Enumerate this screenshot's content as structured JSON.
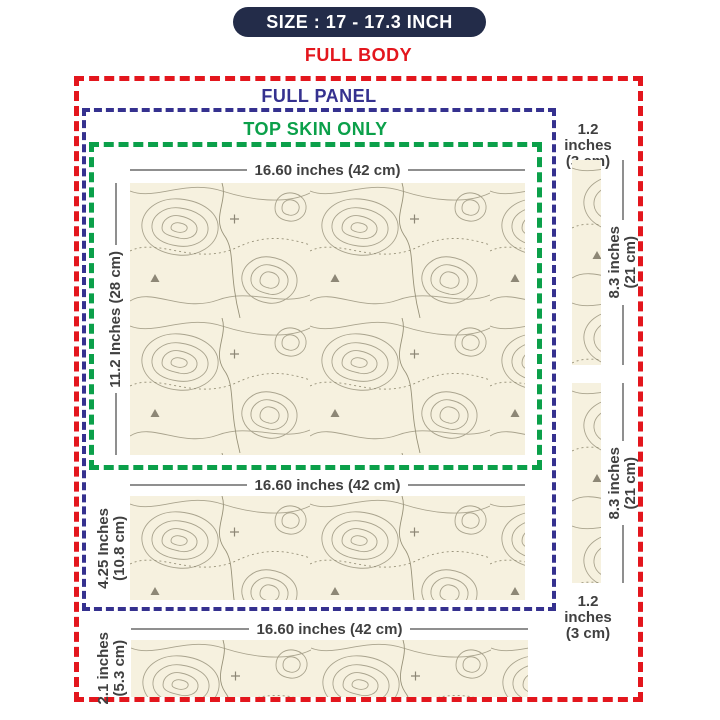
{
  "badge": {
    "text": "SIZE : 17 - 17.3 INCH"
  },
  "region_labels": {
    "full_body": "FULL BODY",
    "full_panel": "FULL PANEL",
    "top_skin": "TOP SKIN ONLY"
  },
  "dimensions": {
    "main": {
      "width": "16.60 inches (42 cm)",
      "height": "11.2 Inches (28 cm)"
    },
    "middle": {
      "width": "16.60 inches (42 cm)",
      "height_line1": "4.25 Inches",
      "height_line2": "(10.8 cm)"
    },
    "bottom": {
      "width": "16.60 inches (42 cm)",
      "height_line1": "2.1 inches",
      "height_line2": "(5.3 cm)"
    },
    "right_top": {
      "width_line1": "1.2 inches",
      "width_line2": "(3 cm)"
    },
    "right_strip1": {
      "height_line1": "8.3 inches",
      "height_line2": "(21 cm)"
    },
    "right_strip2": {
      "height_line1": "8.3 inches",
      "height_line2": "(21 cm)"
    },
    "right_bottom": {
      "width_line1": "1.2 inches",
      "width_line2": "(3 cm)"
    }
  },
  "colors": {
    "full_body_red": "#e3161d",
    "full_panel_navy": "#35318f",
    "top_skin_green": "#0ba04a",
    "badge_navy": "#232c49",
    "skin_cream": "#f6f1df",
    "contour_line": "#a9a38d",
    "dimension_text": "#404040",
    "dimension_line": "#8f8f8f"
  }
}
